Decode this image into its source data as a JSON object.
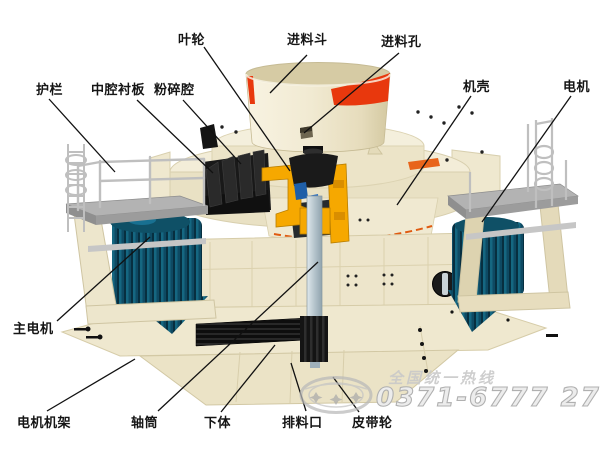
{
  "diagram": {
    "labels": {
      "impeller": "叶轮",
      "feed_hopper": "进料斗",
      "feed_hole": "进料孔",
      "guardrail": "护栏",
      "middle_cavity_liner": "中腔衬板",
      "crushing_chamber": "粉碎腔",
      "casing": "机壳",
      "motor": "电机",
      "main_motor": "主电机",
      "motor_frame": "电机机架",
      "shaft_tube": "轴筒",
      "lower_body": "下体",
      "discharge_port": "排料口",
      "belt_pulley": "皮带轮"
    },
    "watermark": {
      "hotline": "全国统一热线",
      "phone": "0371-6777 2727",
      "logo_icon": "oval-stars-logo"
    },
    "colors": {
      "background": "#FFFFFF",
      "body_cream": "#F1EBD4",
      "accent_red": "#E8380D",
      "accent_orange": "#F6A800",
      "motor_blue": "#0E4A63",
      "shaft_gray": "#B5C4CC",
      "black_parts": "#161616",
      "watermark_gray": "#C6C6C6"
    }
  }
}
